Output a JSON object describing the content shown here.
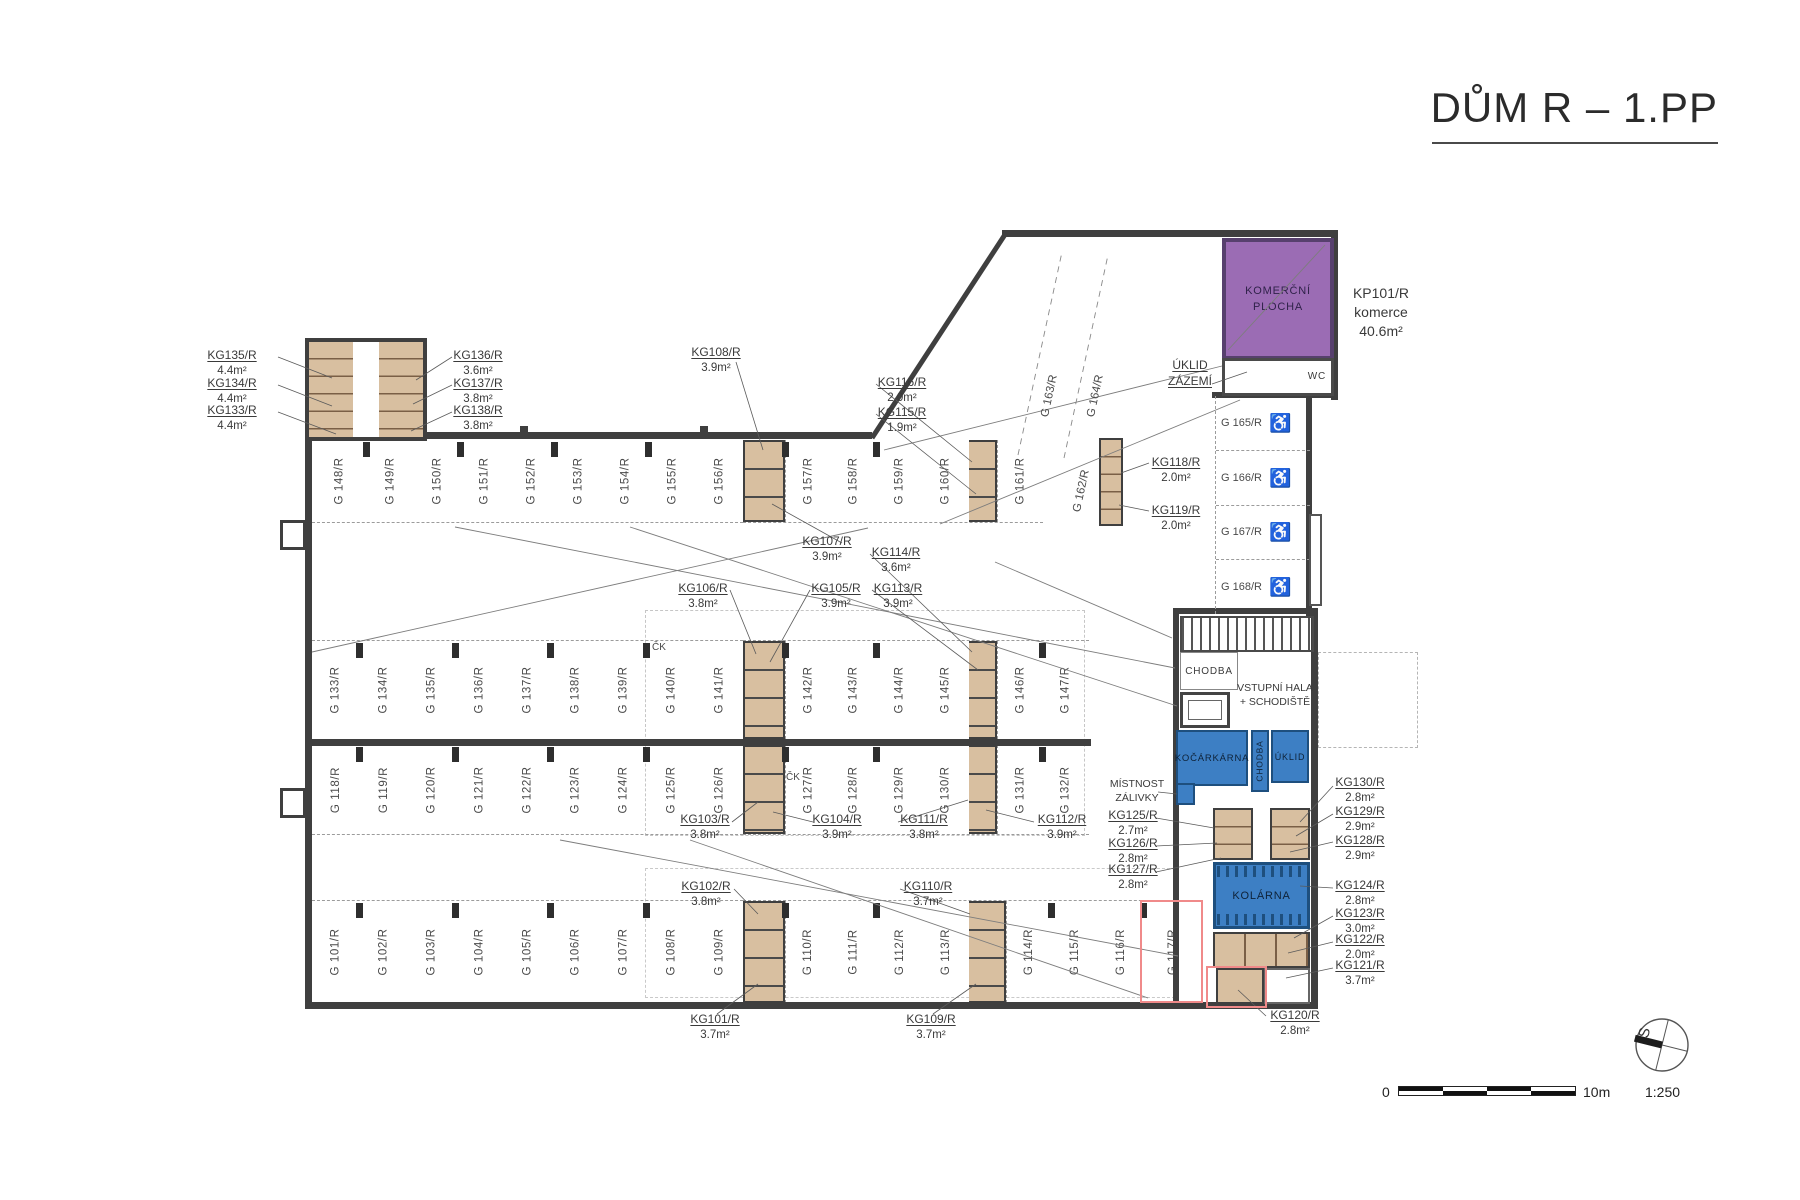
{
  "title": "DŮM R – 1.PP",
  "header_note": {
    "id": "KP101/R",
    "type": "komerce",
    "area": "40.6m²"
  },
  "icons": {
    "wheelchair": "♿",
    "north": "S"
  },
  "scalebar": {
    "zero": "0",
    "max": "10m",
    "ratio": "1:250"
  },
  "colors": {
    "wall": "#3f3f3f",
    "tan": "#d8bfa0",
    "purple": "#9b6cb4",
    "blue": "#3d7fc4",
    "red": "#f08a8a"
  },
  "rooms": {
    "komercni": {
      "line1": "KOMERČNÍ",
      "line2": "PLOCHA"
    },
    "wc": "WC",
    "uklid_zazemi": {
      "line1": "ÚKLID",
      "line2": "ZÁZEMÍ"
    },
    "chodba": "CHODBA",
    "vstupni": {
      "line1": "VSTUPNÍ HALA",
      "line2": "+ SCHODIŠTĚ"
    },
    "kocarkarna": "KOČÁRKÁRNA",
    "chodba2": "CHODBA",
    "uklid": "ÚKLID",
    "mistnost": {
      "line1": "MÍSTNOST",
      "line2": "ZÁLIVKY"
    },
    "kolarna": "KOLÁRNA",
    "ck": "ČK"
  },
  "parking": {
    "row1a": [
      "G 148/R",
      "G 149/R",
      "G 150/R",
      "G 151/R",
      "G 152/R",
      "G 153/R",
      "G 154/R",
      "G 155/R",
      "G 156/R"
    ],
    "row1b": [
      "G 157/R",
      "G 158/R",
      "G 159/R",
      "G 160/R"
    ],
    "row1c": [
      "G 161/R"
    ],
    "row2a": [
      "G 133/R",
      "G 134/R",
      "G 135/R",
      "G 136/R",
      "G 137/R",
      "G 138/R",
      "G 139/R",
      "G 140/R",
      "G 141/R"
    ],
    "row2b": [
      "G 142/R",
      "G 143/R",
      "G 144/R",
      "G 145/R"
    ],
    "row2c": [
      "G 146/R",
      "G 147/R"
    ],
    "row3a": [
      "G 118/R",
      "G 119/R",
      "G 120/R",
      "G 121/R",
      "G 122/R",
      "G 123/R",
      "G 124/R",
      "G 125/R",
      "G 126/R"
    ],
    "row3b": [
      "G 127/R",
      "G 128/R",
      "G 129/R",
      "G 130/R"
    ],
    "row3c": [
      "G 131/R",
      "G 132/R"
    ],
    "row4a": [
      "G 101/R",
      "G 102/R",
      "G 103/R",
      "G 104/R",
      "G 105/R",
      "G 106/R",
      "G 107/R",
      "G 108/R",
      "G 109/R"
    ],
    "row4b": [
      "G 110/R",
      "G 111/R",
      "G 112/R",
      "G 113/R"
    ],
    "row4c": [
      "G 114/R",
      "G 115/R",
      "G 116/R",
      "G 117/R"
    ],
    "angled": [
      "G 163/R",
      "G 164/R",
      "G 162/R"
    ],
    "accessible": [
      "G 165/R",
      "G 166/R",
      "G 167/R",
      "G 168/R"
    ]
  },
  "ann": {
    "kg135": {
      "id": "KG135/R",
      "area": "4.4m²"
    },
    "kg134": {
      "id": "KG134/R",
      "area": "4.4m²"
    },
    "kg133": {
      "id": "KG133/R",
      "area": "4.4m²"
    },
    "kg136": {
      "id": "KG136/R",
      "area": "3.6m²"
    },
    "kg137": {
      "id": "KG137/R",
      "area": "3.8m²"
    },
    "kg138": {
      "id": "KG138/R",
      "area": "3.8m²"
    },
    "kg108": {
      "id": "KG108/R",
      "area": "3.9m²"
    },
    "kg107": {
      "id": "KG107/R",
      "area": "3.9m²"
    },
    "kg116": {
      "id": "KG116/R",
      "area": "2.0m²"
    },
    "kg115": {
      "id": "KG115/R",
      "area": "1.9m²"
    },
    "kg118": {
      "id": "KG118/R",
      "area": "2.0m²"
    },
    "kg119": {
      "id": "KG119/R",
      "area": "2.0m²"
    },
    "kg114": {
      "id": "KG114/R",
      "area": "3.6m²"
    },
    "kg113": {
      "id": "KG113/R",
      "area": "3.9m²"
    },
    "kg105": {
      "id": "KG105/R",
      "area": "3.9m²"
    },
    "kg106": {
      "id": "KG106/R",
      "area": "3.8m²"
    },
    "kg103": {
      "id": "KG103/R",
      "area": "3.8m²"
    },
    "kg104": {
      "id": "KG104/R",
      "area": "3.9m²"
    },
    "kg111": {
      "id": "KG111/R",
      "area": "3.8m²"
    },
    "kg112": {
      "id": "KG112/R",
      "area": "3.9m²"
    },
    "kg102": {
      "id": "KG102/R",
      "area": "3.8m²"
    },
    "kg110": {
      "id": "KG110/R",
      "area": "3.7m²"
    },
    "kg101": {
      "id": "KG101/R",
      "area": "3.7m²"
    },
    "kg109": {
      "id": "KG109/R",
      "area": "3.7m²"
    },
    "kg130": {
      "id": "KG130/R",
      "area": "2.8m²"
    },
    "kg129": {
      "id": "KG129/R",
      "area": "2.9m²"
    },
    "kg128": {
      "id": "KG128/R",
      "area": "2.9m²"
    },
    "kg124": {
      "id": "KG124/R",
      "area": "2.8m²"
    },
    "kg123": {
      "id": "KG123/R",
      "area": "3.0m²"
    },
    "kg122": {
      "id": "KG122/R",
      "area": "2.0m²"
    },
    "kg121": {
      "id": "KG121/R",
      "area": "3.7m²"
    },
    "kg120": {
      "id": "KG120/R",
      "area": "2.8m²"
    },
    "kg125": {
      "id": "KG125/R",
      "area": "2.7m²"
    },
    "kg126": {
      "id": "KG126/R",
      "area": "2.8m²"
    },
    "kg127": {
      "id": "KG127/R",
      "area": "2.8m²"
    }
  }
}
